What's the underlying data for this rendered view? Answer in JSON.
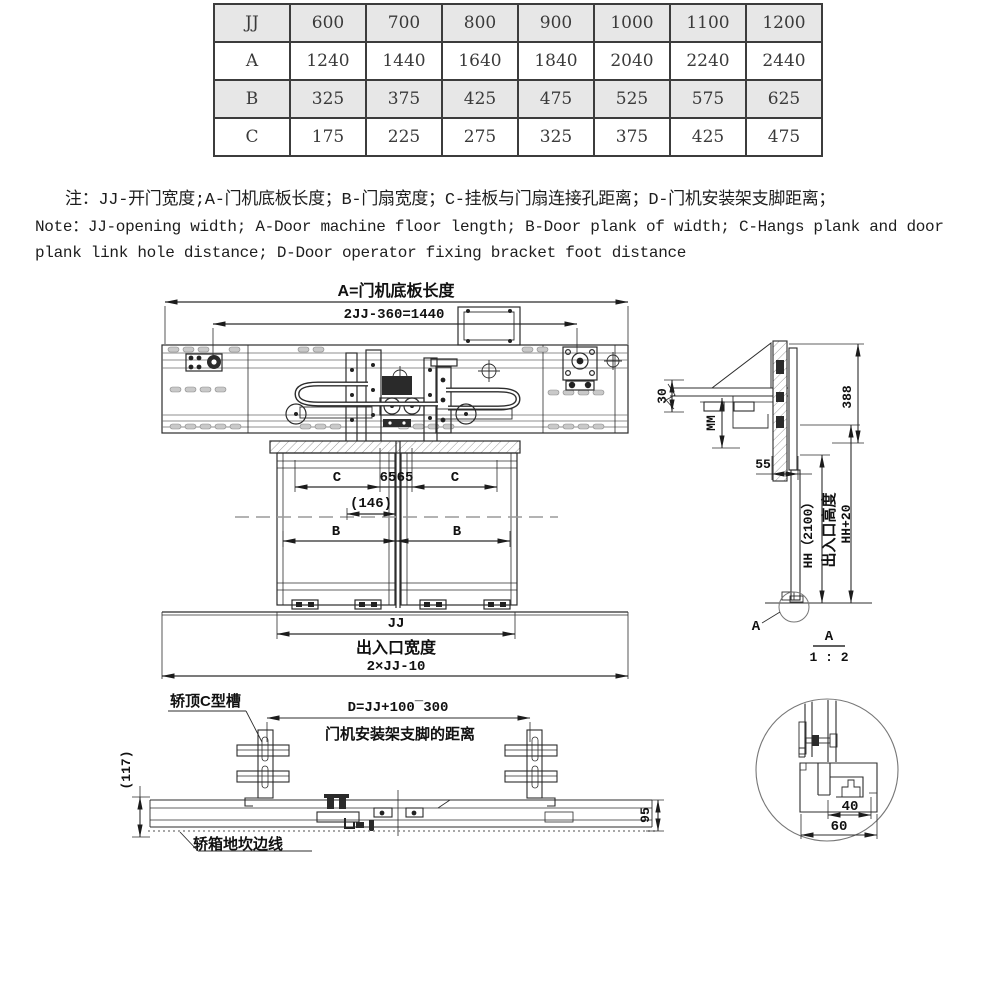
{
  "table": {
    "rows": [
      [
        "JJ",
        "600",
        "700",
        "800",
        "900",
        "1000",
        "1100",
        "1200"
      ],
      [
        "A",
        "1240",
        "1440",
        "1640",
        "1840",
        "2040",
        "2240",
        "2440"
      ],
      [
        "B",
        "325",
        "375",
        "425",
        "475",
        "525",
        "575",
        "625"
      ],
      [
        "C",
        "175",
        "225",
        "275",
        "325",
        "375",
        "425",
        "475"
      ]
    ]
  },
  "notes": {
    "line_cn": "注：JJ-开门宽度;A-门机底板长度；B-门扇宽度；C-挂板与门扇连接孔距离；D-门机安装架支脚距离；",
    "line_en_1": "Note：JJ-opening width; A-Door machine floor length; B-Door plank of width; C-Hangs plank and door",
    "line_en_2": "plank link hole distance; D-Door operator fixing bracket foot distance"
  },
  "front_view": {
    "dim_floor_length": "A=门机底板长度",
    "dim_2jj": "2JJ-360=1440",
    "dim_c_left": "C",
    "dim_65_left": "65",
    "dim_65_right": "65",
    "dim_c_right": "C",
    "dim_146": "(146)",
    "dim_b_left": "B",
    "dim_b_right": "B",
    "dim_jj": "JJ",
    "label_exit_width": "出入口宽度",
    "dim_exit_width": "2×JJ-10"
  },
  "side_view": {
    "dim_30": "30",
    "dim_mm": "MM",
    "dim_388": "388",
    "dim_55": "55",
    "dim_hh": "HH（2100）",
    "label_exit_height": "出入口高度",
    "dim_hh20": "HH+20",
    "detail_marker": "A",
    "section_label": "A",
    "section_scale": "1 : 2"
  },
  "bottom_view": {
    "label_c_channel": "轿顶C型槽",
    "dim_d": "D=JJ+100¯300",
    "label_d_desc": "门机安装架支脚的距离",
    "dim_117": "(117)",
    "dim_95": "95",
    "label_sill_line": "轿箱地坎边线"
  },
  "detail_view": {
    "dim_40": "40",
    "dim_60": "60"
  }
}
